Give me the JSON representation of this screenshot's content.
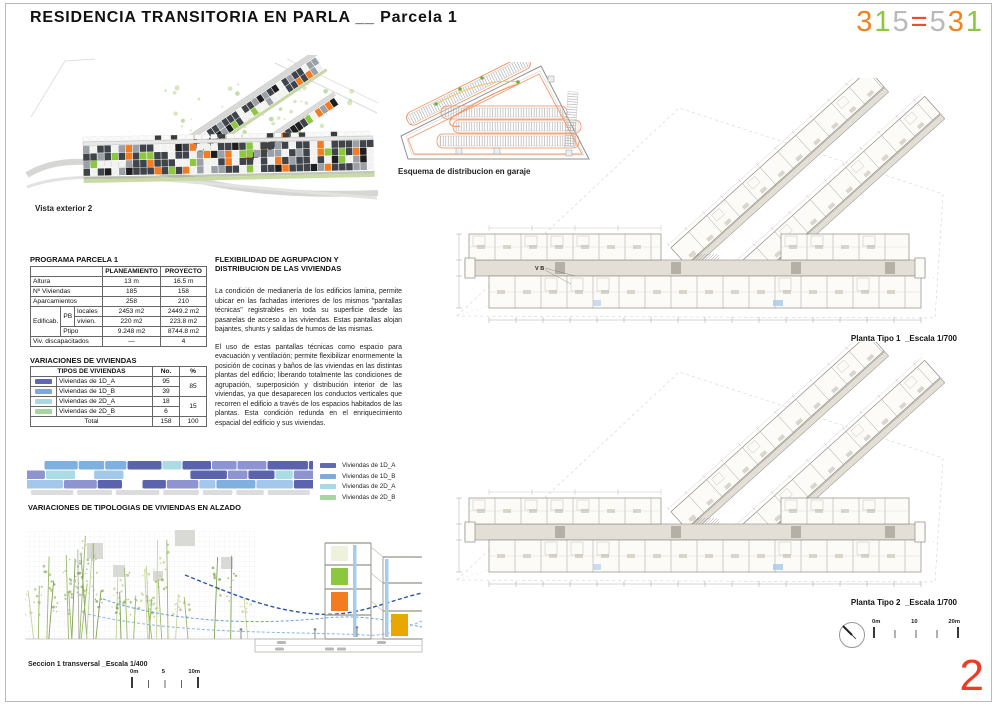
{
  "header": {
    "title": "RESIDENCIA TRANSITORIA EN PARLA __ Parcela 1",
    "logo_chars": [
      {
        "ch": "3",
        "color": "#f0831e"
      },
      {
        "ch": "1",
        "color": "#8dc63f"
      },
      {
        "ch": "5",
        "color": "#b9b9b9"
      },
      {
        "ch": "=",
        "color": "#ea4e26"
      },
      {
        "ch": "5",
        "color": "#b9b9b9"
      },
      {
        "ch": "3",
        "color": "#f0831e"
      },
      {
        "ch": "1",
        "color": "#8dc63f"
      }
    ]
  },
  "page_number": "2",
  "captions": {
    "vista_exterior": "Vista exterior 2",
    "garaje": "Esquema de distribucion en garaje",
    "alzado": "VARIACIONES DE TIPOLOGIAS DE VIVIENDAS EN ALZADO",
    "seccion": "Seccion 1 transversal  _Escala  1/400"
  },
  "plans": [
    {
      "label": "Planta Tipo 1",
      "scale": "_Escala 1/700",
      "annotation": "V B"
    },
    {
      "label": "Planta Tipo 2",
      "scale": "_Escala 1/700",
      "annotation": ""
    }
  ],
  "plan_scalebar": {
    "labels": [
      "0m",
      "10",
      "20m"
    ]
  },
  "section_scalebar": {
    "labels": [
      "0m",
      "5",
      "10m"
    ]
  },
  "programa": {
    "title": "PROGRAMA  PARCELA 1",
    "cols": [
      "PLANEAMIENTO",
      "PROYECTO"
    ],
    "altura": {
      "label": "Altura",
      "plan": "13 m",
      "proy": "16.5 m"
    },
    "nviv": {
      "label": "Nº Viviendas",
      "plan": "185",
      "proy": "158"
    },
    "aparc": {
      "label": "Aparcamientos",
      "plan": "258",
      "proy": "210"
    },
    "edificab_label": "Edificab.",
    "pb_label": "PB",
    "locales": {
      "label": "locales",
      "plan": "2453 m2",
      "proy": "2449.2 m2"
    },
    "vivien": {
      "label": "vivien.",
      "plan": "220 m2",
      "proy": "223.8 m2"
    },
    "ptipo": {
      "label": "Ptipo",
      "plan": "9.248 m2",
      "proy": "8744.8 m2"
    },
    "discap": {
      "label": "Viv. discapacitados",
      "plan": "—",
      "proy": "4"
    }
  },
  "flex": {
    "heading": "FLEXIBILIDAD DE AGRUPACION Y DISTRIBUCION DE LAS VIVIENDAS",
    "para1": "La condición de medianería de los edificios lamina, permite ubicar en las fachadas interiores de los mismos \"pantallas técnicas\" registrables en toda su superficie desde las pasarelas de acceso a las viviendas. Estas pantallas alojan  bajantes, shunts y salidas de humos de las mismas.",
    "para2": "El uso de estas pantallas técnicas como espacio para evacuación y ventilación;  permite flexibilizar enormemente la posición de cocinas y baños de las viviendas en las distintas plantas del edificio; liberando totalmente las condiciones de agrupación, superposición y distribución interior de las viviendas, ya que desaparecen los conductos verticales que recorren el edificio a través de los espacios habitados de las plantas. Esta condición redunda en el  enriquecimiento espacial del edificio y  sus viviendas."
  },
  "viviendas": {
    "title": "VARIACIONES DE VIVIENDAS",
    "header": {
      "tipos": "TIPOS DE VIVIENDAS",
      "no": "No.",
      "pct": "%"
    },
    "rows": [
      {
        "label": "Viviendas de 1D_A",
        "no": "95",
        "color": "#6169b5"
      },
      {
        "label": "Viviendas de 1D_B",
        "no": "39",
        "color": "#7fa9d8"
      },
      {
        "label": "Viviendas de 2D_A",
        "no": "18",
        "color": "#a8d8e4"
      },
      {
        "label": "Viviendas de 2D_B",
        "no": "6",
        "color": "#a5d6a0"
      }
    ],
    "pct_1d": "85",
    "pct_2d": "15",
    "total": {
      "label": "Total",
      "no": "158",
      "pct": "100"
    }
  },
  "palette": {
    "strip_indigo": "#5c63ad",
    "strip_periwinkle": "#8d94cf",
    "strip_blue": "#7fb0de",
    "strip_lightblue": "#a3c8ea",
    "strip_cyan": "#aadce4",
    "strip_green": "#9ccf8f",
    "strip_gray": "#dcdcdc",
    "facade_dark": "#3f444a",
    "facade_white": "#f2f2f0",
    "facade_gray": "#9aa0a6",
    "facade_orange": "#f47b20",
    "facade_green": "#8dc63f",
    "facade_black": "#1e1e1e",
    "plan_line": "#8f8b82",
    "plan_fill": "#fcfbf8",
    "corridor": "#e3dfd7",
    "garage_loop": "#f08a55",
    "garage_dot": "#6fae3e",
    "section_green": "#8dc63f",
    "section_orange": "#f47b20",
    "section_amber": "#eaa700",
    "wave_blue": "#2f55a8",
    "wave_light": "#8ab4e2"
  }
}
